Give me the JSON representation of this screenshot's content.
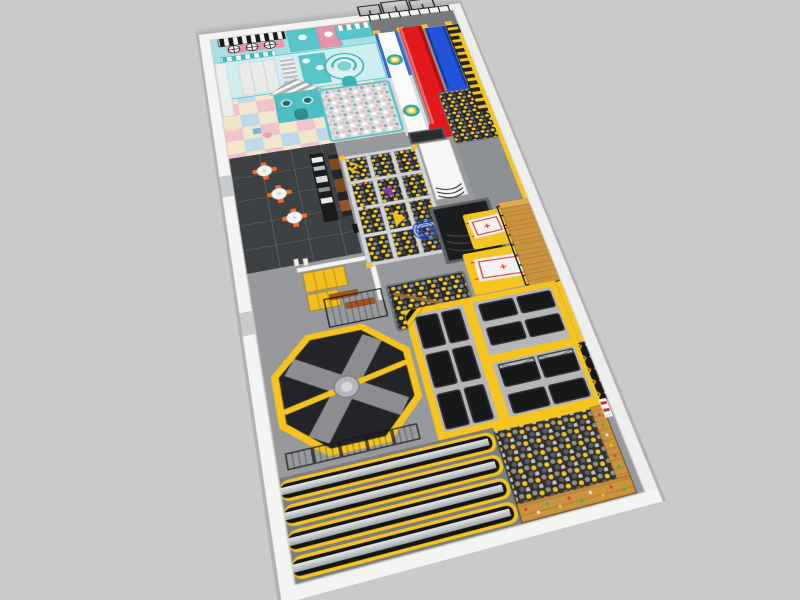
{
  "image": {
    "description": "3D rendered perspective floor-plan view of an indoor trampoline park combined with a kids soft-play center; long rotated hall on a plain gray background; no visible text, labels or UI controls",
    "width_px": 800,
    "height_px": 600
  },
  "palette": {
    "background": "#c9cacb",
    "wall": "#f4f4f2",
    "wall_shadow": "#d6d6d3",
    "carpet": "#97999c",
    "walkway": "#8e9194",
    "dark_tile": "#3e4144",
    "teal": "#56c4c7",
    "teal_light": "#cfeef0",
    "pink": "#e794ab",
    "slide_white": "#fafafa",
    "slide_red": "#e2181c",
    "slide_blue": "#2152da",
    "yellow": "#f5c41e",
    "black_mat": "#17181a",
    "court_pad": "#b4b6b8",
    "wood": "#c9933f",
    "truss_silver": "#d3d6d8",
    "fence_black": "#161616",
    "ball_yellow": "#f3c51d",
    "ball_gray": "#8e9194",
    "ball_white": "#ffffff",
    "ball_pink": "#f0b7c4",
    "chair_orange": "#ee6d2c",
    "spinner_body": "#232427",
    "spinner_blade": "#8b8d90",
    "airbag_mat_red": "#e01f1f"
  },
  "zones": [
    {
      "id": "kids-soft-play",
      "label": "Kids soft play castle in teal/white/pink with black-white striped awning, parasols, striped-roof playhouse, spiral slide and white/pink ball pit on pastel checker floor"
    },
    {
      "id": "slide-tower",
      "label": "Triple slide tower: white slide with teal donut rings, red steep drop slide, blue wave slide ending in yellow ball pit"
    },
    {
      "id": "scaffold",
      "label": "Black scaffold truss and railings above the slide platform"
    },
    {
      "id": "stairs",
      "label": "Access stairs with yellow treads along the top-right wall"
    },
    {
      "id": "cafe",
      "label": "Cafe seating area on dark tile: three round tables with four orange chairs each and a black service counter with equipment"
    },
    {
      "id": "ninja-course",
      "label": "Ninja obstacle course: silver truss grid of 12 cells over yellow/black ball pits with yellow, purple and blue coil obstacles"
    },
    {
      "id": "white-ramp",
      "label": "White ramp structure with black banked lines beside the ninja course"
    },
    {
      "id": "sunken-trampoline",
      "label": "Sunken dark trampoline pit with banked wall"
    },
    {
      "id": "airbag-jump",
      "label": "Yellow stunt airbag pads with white mats marked by red target crosses and a wooden jump platform with black railing"
    },
    {
      "id": "lockers",
      "label": "Yellow locker banks and wooden benches behind a white partition wall with black mesh fence"
    },
    {
      "id": "center-ball-pit",
      "label": "Yellow/black ball pit with wooden balance beam"
    },
    {
      "id": "wipeout-spinner",
      "label": "Octagonal wipeout arena: yellow-edged black octagon, gray cross pad, central hub and rotating yellow sweeper arm"
    },
    {
      "id": "tumbling-tracks",
      "label": "Four long tumbling track lanes with silver runways, black beds and yellow padding"
    },
    {
      "id": "trampoline-court",
      "label": "Trampoline court grid: black jump mats in gray padding with yellow perimeter and divider strips, two mats fenced"
    },
    {
      "id": "foam-pit",
      "label": "Gray/yellow foam ball pit in bottom corner with wooden climbing wall holding red/green/white holds"
    },
    {
      "id": "walkway",
      "label": "Gray walkway along the right wall with yellow wall padding and black/yellow patterned panels"
    }
  ],
  "counts": {
    "slides": 3,
    "cafe_tables": 3,
    "chairs_per_table": 4,
    "ninja_cells": 12,
    "airbag_mats": 2,
    "tumbling_lanes": 4,
    "donut_rings_on_white_slide": 2
  }
}
